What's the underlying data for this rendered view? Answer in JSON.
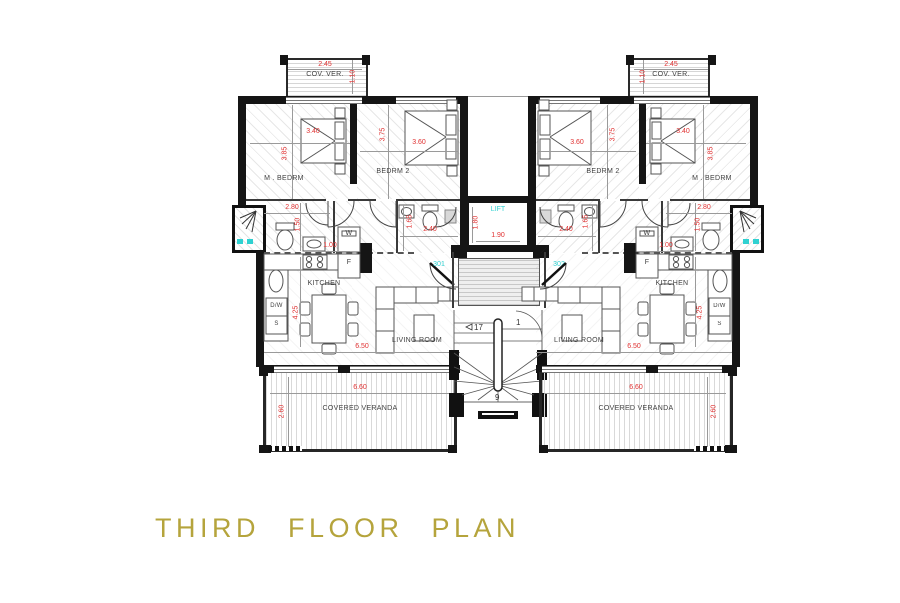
{
  "title": "THIRD FLOOR PLAN",
  "unit": {
    "cov_ver": {
      "label": "COV. VER.",
      "width": "2.45",
      "depth": "1.10"
    },
    "master_bedroom": {
      "label": "M . BEDRM",
      "width": "3.40",
      "depth": "3.85"
    },
    "bedroom_2": {
      "label": "BEDRM 2",
      "width": "3.60",
      "depth": "3.75"
    },
    "bathroom": {
      "width": "2.80",
      "depth": "1.50"
    },
    "ensuite": {
      "basin": "1.65",
      "wc": "2.40"
    },
    "utility": {
      "washer": "W",
      "fridge": "F",
      "width": "1.00"
    },
    "kitchen": {
      "label": "KITCHEN",
      "dishwasher": "D/W",
      "sink": "S",
      "depth": "4.25"
    },
    "living_room": {
      "label": "LIVING ROOM",
      "width": "6.50"
    },
    "veranda": {
      "label": "COVERED VERANDA",
      "width": "6.60",
      "depth": "2.60"
    }
  },
  "core": {
    "lift": {
      "label": "LIFT",
      "width": "1.90",
      "depth": "1.80"
    },
    "apartment_left": "301",
    "apartment_right": "302",
    "stairs": {
      "count_top": "17",
      "count_right": "1",
      "count_bottom": "9"
    }
  },
  "colors": {
    "wall": "#151515",
    "dimension_red": "#e03131",
    "accent_cyan": "#2fd1d1",
    "room_label": "#3f3f3f",
    "title_olive": "#b5a43c"
  }
}
